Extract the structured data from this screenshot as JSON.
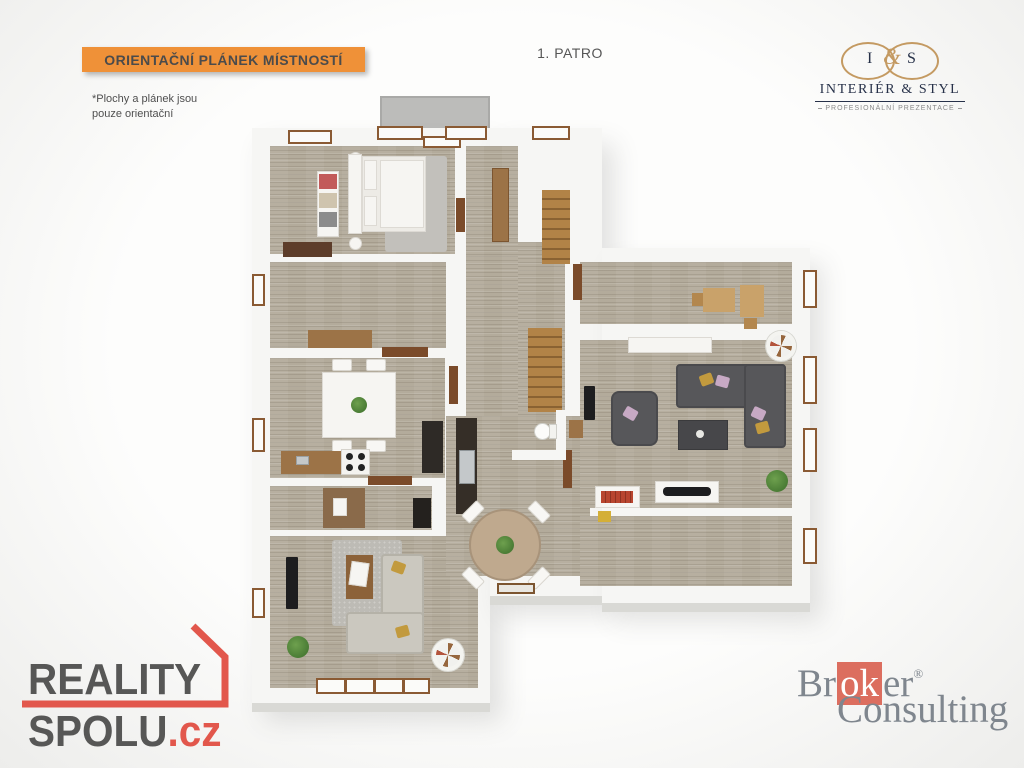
{
  "header": {
    "banner_label": "ORIENTAČNÍ PLÁNEK MÍSTNOSTÍ",
    "disclaimer_line1": "*Plochy  a plánek jsou",
    "disclaimer_line2": "pouze orientační",
    "floor_label": "1. PATRO"
  },
  "logos": {
    "interier_styl": {
      "mono_left": "I",
      "mono_amp": "&",
      "mono_right": "S",
      "title": "INTERIÉR & STYL",
      "subtitle": "PROFESIONÁLNÍ PREZENTACE"
    },
    "reality_spolu": {
      "word1": "REALITY",
      "word2": "SPOLU",
      "tld": ".cz"
    },
    "broker_consulting": {
      "prefix": "Br",
      "highlight": "ok",
      "suffix": "er",
      "registered": "®",
      "word2": "Consulting"
    }
  },
  "colors": {
    "accent_orange": "#ef9138",
    "text_dark": "#4b4b4b",
    "brand_red": "#e2574c",
    "logo_gray": "#575756",
    "broker_red": "#dc6e5f",
    "broker_gray": "#7f868e",
    "navy": "#273149",
    "gold": "#c49a62",
    "floor": "#b3ab9b",
    "wall": "#f6f6f4",
    "wood": "#9c7347",
    "wood_dark": "#5d3d2a",
    "stair_wood": "#b28347",
    "sofa_gray": "#57575a",
    "sofa_beige": "#cbc8bf",
    "plant_green": "#4a7c35"
  }
}
